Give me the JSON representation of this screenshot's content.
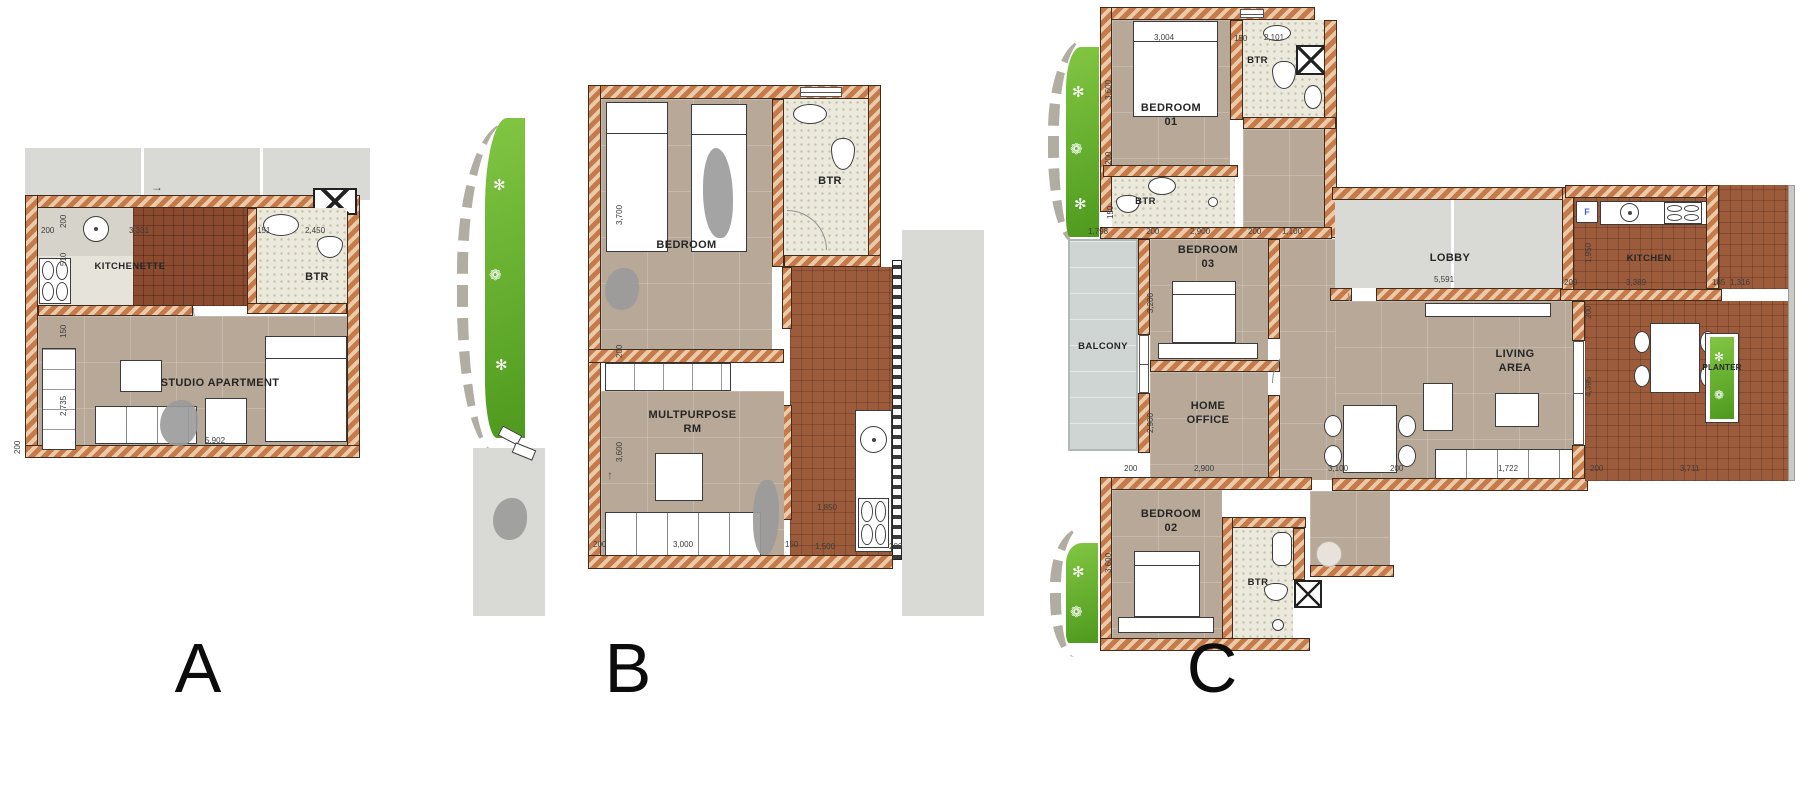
{
  "colors": {
    "wall": "#c57a4c",
    "wallLight": "#eccaa8",
    "wallEdge": "#3f2c1c",
    "tan": "#b7a898",
    "btr": "#ebe8dc",
    "brick": "#9c5c3c",
    "brickDark": "#8a4b30",
    "terrace": "#d9d9d5",
    "balcony": "#ced5d3",
    "green": "#62ac28",
    "label": "#262626"
  },
  "plans": [
    {
      "letter": "A",
      "labels": {
        "kitchenette": "KITCHENETTE",
        "btr": "BTR",
        "studio": "STUDIO APARTMENT"
      },
      "dims": [
        {
          "t": "200",
          "x": 16,
          "y": 78
        },
        {
          "t": "200",
          "x": 34,
          "y": 80,
          "r": 1
        },
        {
          "t": "3,331",
          "x": 104,
          "y": 78
        },
        {
          "t": "151",
          "x": 232,
          "y": 78
        },
        {
          "t": "2,450",
          "x": 280,
          "y": 78
        },
        {
          "t": "510",
          "x": 34,
          "y": 118,
          "r": 1
        },
        {
          "t": "150",
          "x": 34,
          "y": 190,
          "r": 1
        },
        {
          "t": "2,735",
          "x": 34,
          "y": 268,
          "r": 1
        },
        {
          "t": "5,902",
          "x": 180,
          "y": 288
        },
        {
          "t": "200",
          "x": -12,
          "y": 306,
          "r": 1
        }
      ]
    },
    {
      "letter": "B",
      "labels": {
        "bedroom": "BEDROOM",
        "btr": "BTR",
        "multipurpose": "MULTPURPOSE\nRM"
      },
      "dims": [
        {
          "t": "3,700",
          "x": 160,
          "y": 165,
          "r": 1
        },
        {
          "t": "200",
          "x": 160,
          "y": 298,
          "r": 1
        },
        {
          "t": "3,600",
          "x": 160,
          "y": 402,
          "r": 1
        },
        {
          "t": "1,850",
          "x": 362,
          "y": 443
        },
        {
          "t": "200",
          "x": 138,
          "y": 480
        },
        {
          "t": "3,000",
          "x": 218,
          "y": 480
        },
        {
          "t": "150",
          "x": 330,
          "y": 480
        },
        {
          "t": "1,500",
          "x": 360,
          "y": 482
        },
        {
          "t": "200",
          "x": 434,
          "y": 482
        }
      ]
    },
    {
      "letter": "C",
      "labels": {
        "bedroom01": "BEDROOM\n01",
        "btr_top": "BTR",
        "btr_mid": "BTR",
        "bedroom03": "BEDROOM\n03",
        "balcony": "BALCONY",
        "home_office": "HOME\nOFFICE",
        "lobby": "LOBBY",
        "kitchen": "KITCHEN",
        "living": "LIVING\nAREA",
        "planter": "PLANTER",
        "bedroom02": "BEDROOM\n02",
        "btr_bottom": "BTR",
        "fridge": "F"
      },
      "dims": [
        {
          "t": "3,004",
          "x": 234,
          "y": 28
        },
        {
          "t": "150",
          "x": 314,
          "y": 29
        },
        {
          "t": "2,101",
          "x": 344,
          "y": 28
        },
        {
          "t": "3,600",
          "x": 184,
          "y": 95,
          "r": 1
        },
        {
          "t": "200",
          "x": 184,
          "y": 160,
          "r": 1
        },
        {
          "t": "1,798",
          "x": 168,
          "y": 222
        },
        {
          "t": "200",
          "x": 226,
          "y": 222
        },
        {
          "t": "2,900",
          "x": 270,
          "y": 222
        },
        {
          "t": "200",
          "x": 328,
          "y": 222
        },
        {
          "t": "1,100",
          "x": 362,
          "y": 222
        },
        {
          "t": "150",
          "x": 186,
          "y": 214,
          "r": 1
        },
        {
          "t": "3,200",
          "x": 226,
          "y": 308,
          "r": 1
        },
        {
          "t": "2,900",
          "x": 226,
          "y": 428,
          "r": 1
        },
        {
          "t": "5,591",
          "x": 514,
          "y": 270
        },
        {
          "t": "1,950",
          "x": 664,
          "y": 258,
          "r": 1
        },
        {
          "t": "200",
          "x": 644,
          "y": 273
        },
        {
          "t": "3,389",
          "x": 706,
          "y": 273
        },
        {
          "t": "185",
          "x": 792,
          "y": 273
        },
        {
          "t": "1,316",
          "x": 810,
          "y": 273
        },
        {
          "t": "200",
          "x": 664,
          "y": 314,
          "r": 1
        },
        {
          "t": "4,395",
          "x": 664,
          "y": 392,
          "r": 1
        },
        {
          "t": "200",
          "x": 204,
          "y": 459
        },
        {
          "t": "2,900",
          "x": 274,
          "y": 459
        },
        {
          "t": "3,100",
          "x": 408,
          "y": 459
        },
        {
          "t": "200",
          "x": 470,
          "y": 459
        },
        {
          "t": "1,722",
          "x": 578,
          "y": 459
        },
        {
          "t": "200",
          "x": 670,
          "y": 459
        },
        {
          "t": "3,711",
          "x": 760,
          "y": 459
        },
        {
          "t": "3,600",
          "x": 184,
          "y": 568,
          "r": 1
        }
      ]
    }
  ]
}
